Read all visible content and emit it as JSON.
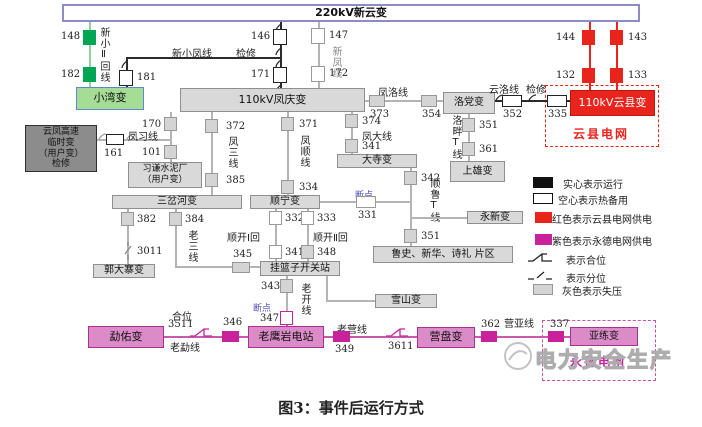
{
  "top_bus": "220kV新云变",
  "caption": "图3：事件后运行方式",
  "watermark": "电力安全生产",
  "colors": {
    "run_green": "#00a651",
    "yunxian_red": "#e8241d",
    "yongde_magenta": "#c9219c",
    "lost_voltage_gray": "#d4d4d4",
    "note_blue": "#4d50bd",
    "bus_border_blue": "#8b8bc8"
  },
  "stations": {
    "xiaowan": "小湾变",
    "fengqing": "110kV凤庆变",
    "yunxian": "110kV云县变",
    "luodang": "洛党变",
    "shangxiong": "上雄变",
    "yunfeng_temp": "云凤高速\n临时变\n（用户变）\n检修",
    "xiqian": "习谦水泥厂\n（用户变）",
    "dasi": "大寺变",
    "yongxin": "永新变",
    "sanchahe": "三岔河变",
    "shunning": "顺宁变",
    "guodazhai": "郭大寨变",
    "gualanzi": "挂篮子开关站",
    "lushi_area": "鲁史、新华、诗礼 片区",
    "xueshan": "雪山变",
    "mengyou": "勐佑变",
    "laoyingyan": "老鹰岩电站",
    "yingpan": "营盘变",
    "yalian": "亚练变"
  },
  "grids": {
    "yunxian": "云县电网",
    "yongde": "永德电网"
  },
  "lines": {
    "xinxiao2": "新小Ⅱ回线",
    "xinxiaofeng": "新小凤线",
    "xinfeng": "新凤线",
    "fengluo": "凤洛线",
    "yunluo": "云洛线",
    "fengxi": "凤习线",
    "fengsan": "凤三线",
    "fengshun": "凤顺线",
    "fengda": "凤大线",
    "luopanT": "洛畔T线",
    "shunluT": "顺鲁T线",
    "laosan": "老三线",
    "shunkai1": "顺开Ⅰ回",
    "shunkai2": "顺开Ⅱ回",
    "laokai": "老开线",
    "laomeng": "老勐线",
    "laoying": "老营线",
    "yingya": "营亚线"
  },
  "notes": {
    "maint_top": "检修",
    "maint_yunluo": "检修",
    "breakpoint_331": "断点",
    "breakpoint_347": "断点",
    "closed_pos": "合位"
  },
  "breakers": {
    "b148": "148",
    "b182": "182",
    "b181": "181",
    "b146": "146",
    "b171": "171",
    "b147": "147",
    "b172": "172",
    "b144": "144",
    "b143": "143",
    "b132": "132",
    "b133": "133",
    "b373": "373",
    "b354": "354",
    "b352": "352",
    "b335": "335",
    "b351a": "351",
    "b361": "361",
    "b161": "161",
    "b170": "170",
    "b101": "101",
    "b372": "372",
    "b385": "385",
    "b371": "371",
    "b334": "334",
    "b374": "374",
    "b341a": "341",
    "b342": "342",
    "b331": "331",
    "b351b": "351",
    "b382": "382",
    "b3011": "3011",
    "b384": "384",
    "b345": "345",
    "b332": "332",
    "b333": "333",
    "b341b": "341",
    "b348": "348",
    "b343": "343",
    "b347": "347",
    "b3511": "3511",
    "b346": "346",
    "b349": "349",
    "b3611": "3611",
    "b362": "362",
    "b337": "337"
  },
  "legend": {
    "solid": "实心表示运行",
    "hollow": "空心表示热备用",
    "red": "红色表示云县电网供电",
    "purple": "紫色表示永德电网供电",
    "closed": "表示合位",
    "open": "表示分位",
    "gray": "灰色表示失压"
  }
}
